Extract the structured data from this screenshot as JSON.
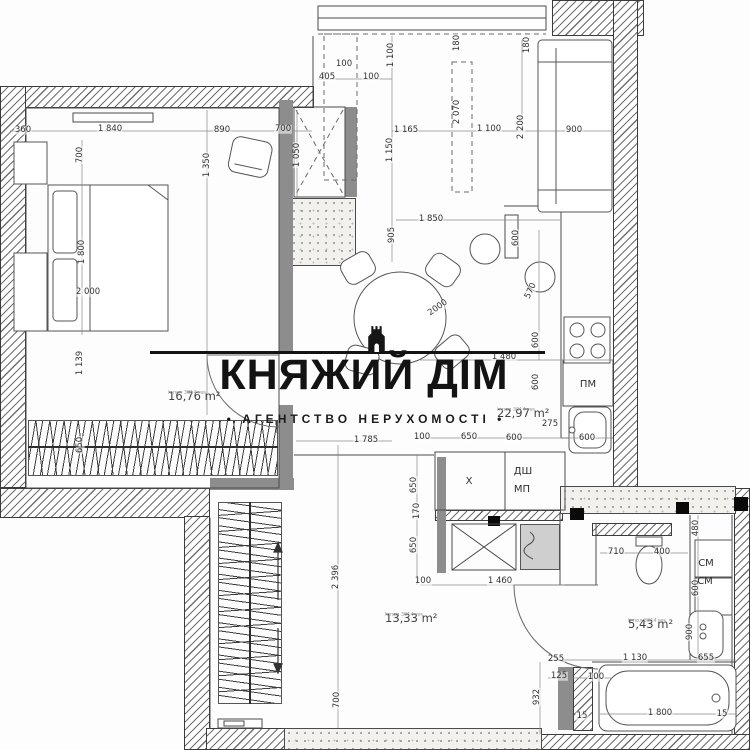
{
  "watermark": {
    "title": "КНЯЖИЙ ДІМ",
    "subtitle": "• АГЕНТСТВО НЕРУХОМОСТІ •"
  },
  "rooms": [
    {
      "id": "bedroom",
      "area": "16,76 m²",
      "note": "h пол 3014 мм",
      "x": 168,
      "y": 389
    },
    {
      "id": "living-kitchen",
      "area": "22,97 m²",
      "note": "h пол 3014 мм",
      "x": 497,
      "y": 406
    },
    {
      "id": "hallway",
      "area": "13,33 m²",
      "note": "h пол 3014 мм",
      "x": 385,
      "y": 611
    },
    {
      "id": "bathroom",
      "area": "5,43 m²",
      "note": "h пол 3014 мм",
      "x": 628,
      "y": 617
    }
  ],
  "fixtures": [
    {
      "id": "dishwasher",
      "label": "ПМ",
      "x": 588,
      "y": 385
    },
    {
      "id": "closet-x",
      "label": "X",
      "x": 469,
      "y": 482
    },
    {
      "id": "duct-dsh",
      "label": "ДШ",
      "x": 523,
      "y": 472
    },
    {
      "id": "duct-mp",
      "label": "МП",
      "x": 522,
      "y": 490
    },
    {
      "id": "washer",
      "label": "СМ",
      "x": 706,
      "y": 564
    },
    {
      "id": "dryer",
      "label": "СМ",
      "x": 705,
      "y": 582
    }
  ],
  "dims": [
    {
      "t": "360",
      "x": 23,
      "y": 130,
      "r": 0
    },
    {
      "t": "1 840",
      "x": 110,
      "y": 129,
      "r": 0
    },
    {
      "t": "890",
      "x": 222,
      "y": 130,
      "r": 0
    },
    {
      "t": "700",
      "x": 283,
      "y": 129,
      "r": 0
    },
    {
      "t": "700",
      "x": 80,
      "y": 155,
      "r": -90
    },
    {
      "t": "1 350",
      "x": 207,
      "y": 165,
      "r": -90
    },
    {
      "t": "1 050",
      "x": 297,
      "y": 155,
      "r": -90
    },
    {
      "t": "1 800",
      "x": 82,
      "y": 252,
      "r": -90
    },
    {
      "t": "2 000",
      "x": 88,
      "y": 292,
      "r": 0
    },
    {
      "t": "1 139",
      "x": 80,
      "y": 363,
      "r": -90
    },
    {
      "t": "650",
      "x": 80,
      "y": 445,
      "r": -90
    },
    {
      "t": "100",
      "x": 344,
      "y": 64,
      "r": 0
    },
    {
      "t": "405",
      "x": 327,
      "y": 77,
      "r": 0
    },
    {
      "t": "100",
      "x": 371,
      "y": 77,
      "r": 0
    },
    {
      "t": "1 100",
      "x": 391,
      "y": 55,
      "r": -90
    },
    {
      "t": "180",
      "x": 457,
      "y": 43,
      "r": -90
    },
    {
      "t": "180",
      "x": 527,
      "y": 45,
      "r": -90
    },
    {
      "t": "2 070",
      "x": 457,
      "y": 112,
      "r": -90
    },
    {
      "t": "1 165",
      "x": 406,
      "y": 130,
      "r": 0
    },
    {
      "t": "1 150",
      "x": 390,
      "y": 150,
      "r": -90
    },
    {
      "t": "1 100",
      "x": 489,
      "y": 129,
      "r": 0
    },
    {
      "t": "2 200",
      "x": 521,
      "y": 127,
      "r": -90
    },
    {
      "t": "900",
      "x": 574,
      "y": 130,
      "r": 0
    },
    {
      "t": "1 850",
      "x": 431,
      "y": 219,
      "r": 0
    },
    {
      "t": "905",
      "x": 392,
      "y": 235,
      "r": -90
    },
    {
      "t": "600",
      "x": 516,
      "y": 238,
      "r": -90
    },
    {
      "t": "570",
      "x": 531,
      "y": 291,
      "r": -65
    },
    {
      "t": "2000",
      "x": 438,
      "y": 308,
      "r": -35
    },
    {
      "t": "600",
      "x": 536,
      "y": 340,
      "r": -90
    },
    {
      "t": "600",
      "x": 536,
      "y": 382,
      "r": -90
    },
    {
      "t": "1 480",
      "x": 504,
      "y": 357,
      "r": 0
    },
    {
      "t": "275",
      "x": 550,
      "y": 424,
      "r": 0
    },
    {
      "t": "100",
      "x": 422,
      "y": 437,
      "r": 0
    },
    {
      "t": "650",
      "x": 469,
      "y": 437,
      "r": 0
    },
    {
      "t": "600",
      "x": 514,
      "y": 438,
      "r": 0
    },
    {
      "t": "600",
      "x": 587,
      "y": 438,
      "r": 0
    },
    {
      "t": "650",
      "x": 414,
      "y": 485,
      "r": -90
    },
    {
      "t": "170",
      "x": 417,
      "y": 511,
      "r": -90
    },
    {
      "t": "650",
      "x": 414,
      "y": 545,
      "r": -90
    },
    {
      "t": "100",
      "x": 423,
      "y": 581,
      "r": 0
    },
    {
      "t": "1 460",
      "x": 500,
      "y": 581,
      "r": 0
    },
    {
      "t": "1 785",
      "x": 366,
      "y": 440,
      "r": 0
    },
    {
      "t": "2 396",
      "x": 336,
      "y": 577,
      "r": -90
    },
    {
      "t": "700",
      "x": 337,
      "y": 700,
      "r": -90
    },
    {
      "t": "710",
      "x": 616,
      "y": 552,
      "r": 0
    },
    {
      "t": "400",
      "x": 662,
      "y": 552,
      "r": 0
    },
    {
      "t": "480",
      "x": 696,
      "y": 528,
      "r": -90
    },
    {
      "t": "600",
      "x": 696,
      "y": 588,
      "r": -90
    },
    {
      "t": "900",
      "x": 690,
      "y": 632,
      "r": -90
    },
    {
      "t": "1 130",
      "x": 635,
      "y": 658,
      "r": 0
    },
    {
      "t": "655",
      "x": 706,
      "y": 658,
      "r": 0
    },
    {
      "t": "255",
      "x": 556,
      "y": 659,
      "r": 0
    },
    {
      "t": "125",
      "x": 559,
      "y": 676,
      "r": 0
    },
    {
      "t": "100",
      "x": 596,
      "y": 677,
      "r": 0
    },
    {
      "t": "932",
      "x": 537,
      "y": 697,
      "r": -90
    },
    {
      "t": "1 800",
      "x": 660,
      "y": 713,
      "r": 0
    },
    {
      "t": "15",
      "x": 582,
      "y": 716,
      "r": 0
    },
    {
      "t": "15",
      "x": 722,
      "y": 714,
      "r": 0
    }
  ]
}
